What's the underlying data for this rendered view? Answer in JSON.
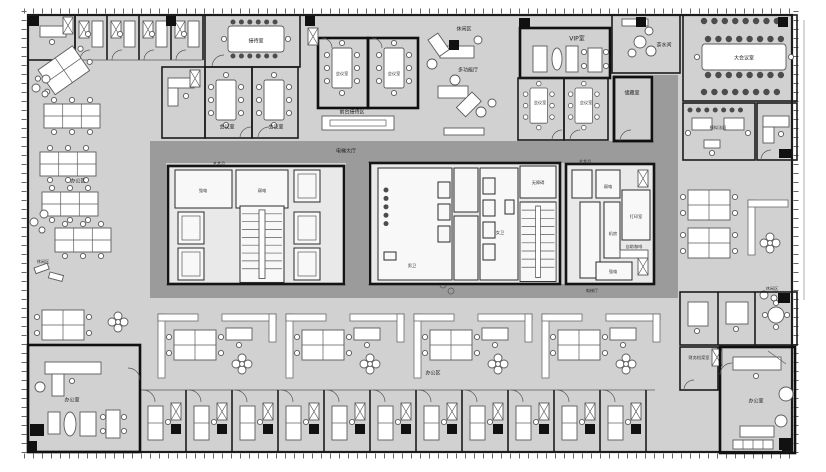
{
  "meta": {
    "description": "Office floor plan drawing (architectural CAD style)",
    "palette": {
      "floor": "#d1d1d1",
      "corridor": "#9b9b9b",
      "walls": "#141414",
      "furniture": "#ffffff",
      "background": "#ffffff"
    }
  },
  "labels": [
    {
      "id": "reception-room",
      "text": "接待室"
    },
    {
      "id": "meeting-room-a",
      "text": "会议室"
    },
    {
      "id": "meeting-room-b",
      "text": "会议室"
    },
    {
      "id": "meeting-room-c",
      "text": "会议室"
    },
    {
      "id": "meeting-room-d",
      "text": "会议室"
    },
    {
      "id": "front-desk-area",
      "text": "前台接待区"
    },
    {
      "id": "lounge-mid",
      "text": "休闲区"
    },
    {
      "id": "multi-function-hall",
      "text": "多功能厅"
    },
    {
      "id": "vip-room",
      "text": "VIP室"
    },
    {
      "id": "meeting-room-e",
      "text": "会议室"
    },
    {
      "id": "meeting-room-f",
      "text": "会议室"
    },
    {
      "id": "pantry-ne",
      "text": "茶水间"
    },
    {
      "id": "storage-room",
      "text": "储藏室"
    },
    {
      "id": "grand-conference-room",
      "text": "大会议室"
    },
    {
      "id": "mock-court",
      "text": "模拟法庭"
    },
    {
      "id": "office-area-left",
      "text": "办公区"
    },
    {
      "id": "lounge-left",
      "text": "休闲区"
    },
    {
      "id": "office-area-bottom",
      "text": "办公区"
    },
    {
      "id": "office-sw",
      "text": "办公室"
    },
    {
      "id": "office-se",
      "text": "办公室"
    },
    {
      "id": "finance-archive-room",
      "text": "财务档案室"
    },
    {
      "id": "elevator-hall-main",
      "text": "电梯大厅"
    },
    {
      "id": "elevator-hall-east",
      "text": "电梯厅"
    },
    {
      "id": "mens-wc",
      "text": "男卫"
    },
    {
      "id": "womens-wc",
      "text": "女卫"
    },
    {
      "id": "strong-electric",
      "text": "强电"
    },
    {
      "id": "weak-electric",
      "text": "弱电"
    },
    {
      "id": "print-room",
      "text": "打印室"
    },
    {
      "id": "machine-room",
      "text": "机房"
    },
    {
      "id": "coffee-station",
      "text": "自助咖啡"
    },
    {
      "id": "art-spot-west",
      "text": "艺术品"
    },
    {
      "id": "art-spot-east",
      "text": "艺术品"
    },
    {
      "id": "accessible-wc",
      "text": "无障碍"
    },
    {
      "id": "weak-electric-2",
      "text": "弱电"
    },
    {
      "id": "strong-electric-2",
      "text": "强电"
    },
    {
      "id": "lounge-right",
      "text": "休闲区"
    }
  ]
}
